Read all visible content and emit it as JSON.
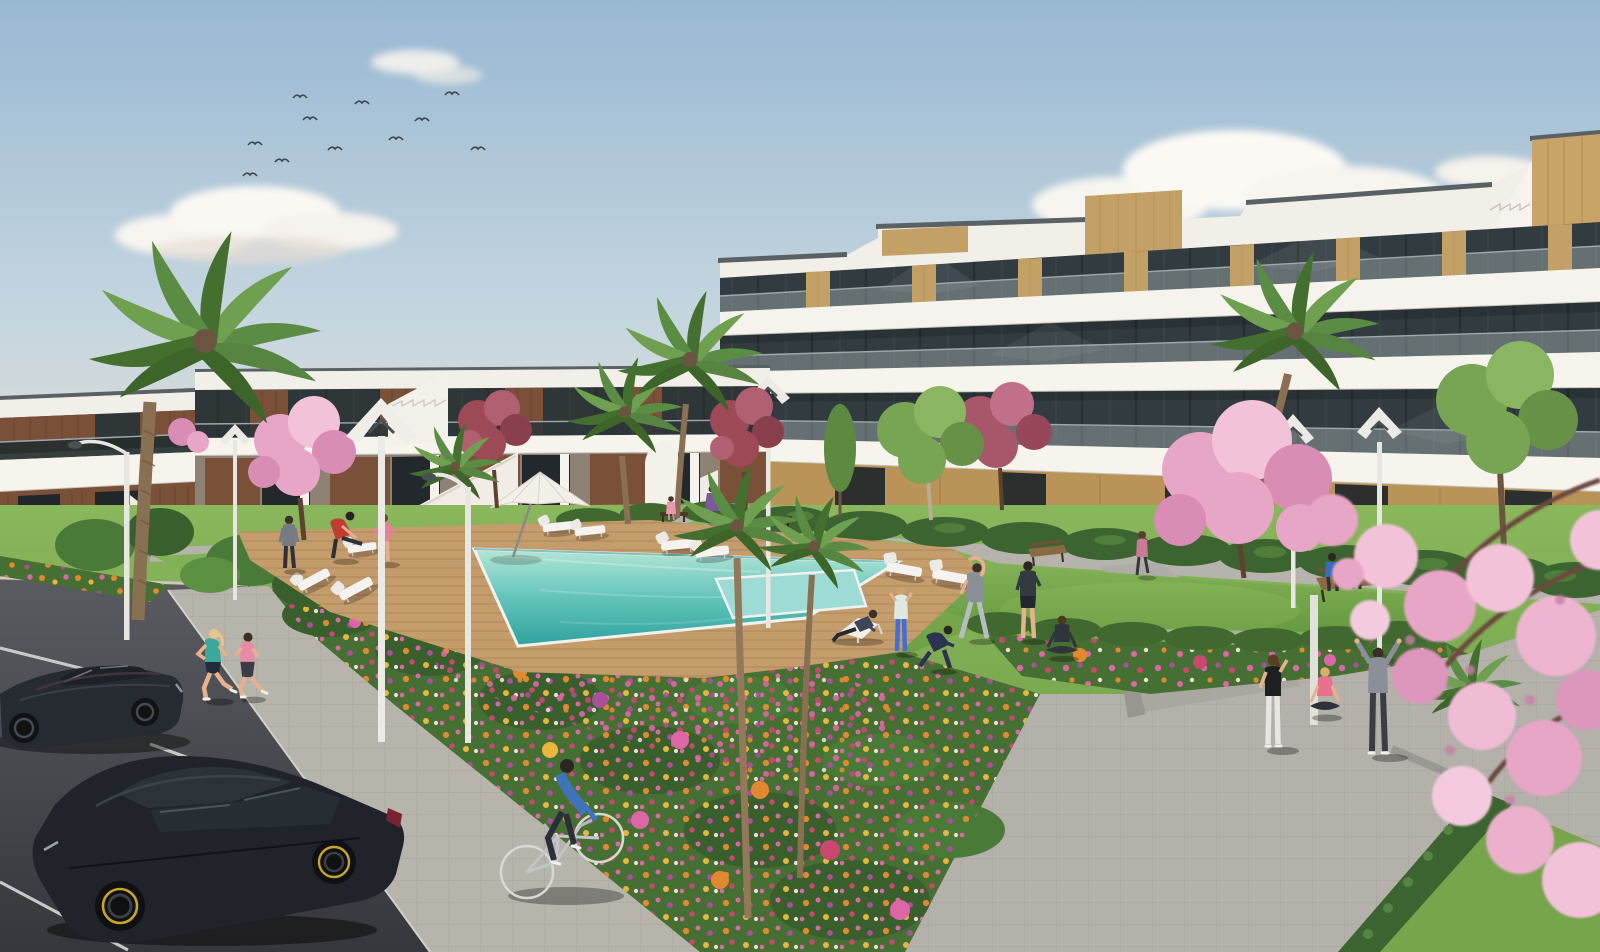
{
  "scene": {
    "type": "architectural_exterior_render",
    "description": "Sunny 3D visualization of a modern white residential complex: a four-storey apartment block with stacked balconies and oak cladding on the right, two-storey townhouses on the left, a turquoise pool with timber deck and loungers in the center, flower beds, palms, cherry-blossom trees, a parking lot with two black cars, joggers, a cyclist and people exercising on the lawns",
    "time_of_day": "daytime, clear sky with small clouds and a flock of birds",
    "camera": "elevated three-quarter view"
  },
  "palette": {
    "sky_top": "#98b8d2",
    "sky_mid": "#c4d5df",
    "sky_low": "#e3e1d5",
    "sky_horizon": "#eae5d8",
    "cloud": "#f8f5f1",
    "bird": "#3e474c",
    "building_white": "#f6f3ee",
    "building_parapet": "#f2efe9",
    "coping_dark": "#5a6165",
    "glass_dark": "#323c40",
    "glass_left": "#2e3638",
    "balustrade": "#b9c6c9",
    "wood_oak": "#c3a066",
    "wood_mid": "#b99358",
    "wood_dark": "#7a5138",
    "shade_wall": "#8d8274",
    "hedge_dark": "#3c6430",
    "hedge_mid": "#4c7a3a",
    "hedge_light": "#5f9246",
    "lawn_light": "#8ab65c",
    "lawn_dark": "#659a40",
    "bed_green": "#466f33",
    "deck_wood": "#c59d6d",
    "pool_light": "#b4e6d6",
    "pool_mid": "#63c4bb",
    "pool_deep": "#2fa29e",
    "kids_pool": "#9edbd4",
    "pool_rim": "#eef3f0",
    "walkway": "#b5b3ac",
    "promenade": "#b3b1aa",
    "sidewalk": "#b7b4ab",
    "asphalt_top": "#5a5b60",
    "asphalt_bottom": "#36373c",
    "parking_line": "#d8d8d2",
    "kerb": "#cbc8c0",
    "lamp_pole": "#e8e6e1",
    "lamp_head_dark": "#4a4f52",
    "bench_wood": "#8a6a44",
    "bench_dark": "#4a3826",
    "blossom_light": "#f2c3d8",
    "blossom_mid": "#e8a6c6",
    "blossom_deep": "#d98cb4",
    "plum_red": "#9e4a56",
    "plum_red_light": "#b06070",
    "tree_green": "#78a554",
    "palm_green": "#5b8c44",
    "palm_green_dark": "#44702f",
    "palm_trunk": "#8a7052",
    "flower_orange": "#e2892f",
    "flower_pink": "#dd66a7",
    "flower_magenta": "#a94f9c",
    "flower_yellow": "#e8b53e",
    "car_sedan": "#262b31",
    "car_hatchback": "#20242a",
    "wheel_accent": "#c8a42c",
    "skin": "#e6b28e"
  },
  "counts": {
    "clouds": 4,
    "birds": 11,
    "sun_loungers": 9,
    "parasols": 1,
    "benches": 4,
    "street_lamps": 7,
    "palms": 8,
    "cherry_trees": 3,
    "plum_trees": 2,
    "green_trees": 3,
    "flower_beds": 4,
    "cars": 2,
    "bicycles": 1,
    "people": 20,
    "steps": 3
  },
  "buildings": {
    "left_row": {
      "storeys": 2,
      "style": "white townhouses with dark timber cladding, external stairs, glass balustrades"
    },
    "right_block": {
      "storeys": 4,
      "style": "white stacked balconies, tinted glazing, oak towers, rooftop stair parapets"
    }
  },
  "people": [
    {
      "id": "jogger-1",
      "activity": "jogging",
      "top": "#3aa89a"
    },
    {
      "id": "jogger-2",
      "activity": "jogging",
      "top": "#e88aa6"
    },
    {
      "id": "cyclist",
      "activity": "cycling",
      "top": "#3f74b8"
    },
    {
      "id": "stretch-man-red",
      "activity": "leg stretch on lounger",
      "top": "#c23c32"
    },
    {
      "id": "man-gray",
      "activity": "standing",
      "top": "#767b83"
    },
    {
      "id": "woman-pink",
      "activity": "standing",
      "top": "#e87f9f"
    },
    {
      "id": "woman-walking-purple",
      "activity": "walking",
      "top": "#7a5a9a"
    },
    {
      "id": "child-pink",
      "activity": "walking",
      "top": "#e89ab0"
    },
    {
      "id": "sunbather-navy",
      "activity": "sitting on deck chair",
      "top": "#3c465a"
    },
    {
      "id": "woman-teal-white",
      "activity": "stretching",
      "top": "#dfe9e4"
    },
    {
      "id": "lunge-navy",
      "activity": "lunging",
      "top": "#2c3350"
    },
    {
      "id": "sidestretch-gray",
      "activity": "side stretch",
      "top": "#8a9098"
    },
    {
      "id": "stand-navy",
      "activity": "standing",
      "top": "#343a42"
    },
    {
      "id": "yoga-dark",
      "activity": "seated yoga",
      "top": "#30343c"
    },
    {
      "id": "walker-rose",
      "activity": "walking",
      "top": "#c87a96"
    },
    {
      "id": "bench-man-blue",
      "activity": "sitting on bench",
      "top": "#3a6db8"
    },
    {
      "id": "bench-woman-pink",
      "activity": "sitting on bench",
      "top": "#d884a4"
    },
    {
      "id": "trio-black-top",
      "activity": "stretching",
      "top": "#1d2023"
    },
    {
      "id": "trio-pink-sitting",
      "activity": "sitting on step",
      "top": "#e8728e"
    },
    {
      "id": "trio-gray-hoodie",
      "activity": "arms raised stretch",
      "top": "#8a8f99"
    }
  ],
  "vehicles": [
    {
      "id": "sedan",
      "color": "#262b31",
      "state": "parked"
    },
    {
      "id": "hatchback",
      "color": "#20242a",
      "wheel_accent": "#c8a42c",
      "state": "parked"
    },
    {
      "id": "bicycle",
      "rider_top": "#3f74b8",
      "state": "riding"
    }
  ]
}
